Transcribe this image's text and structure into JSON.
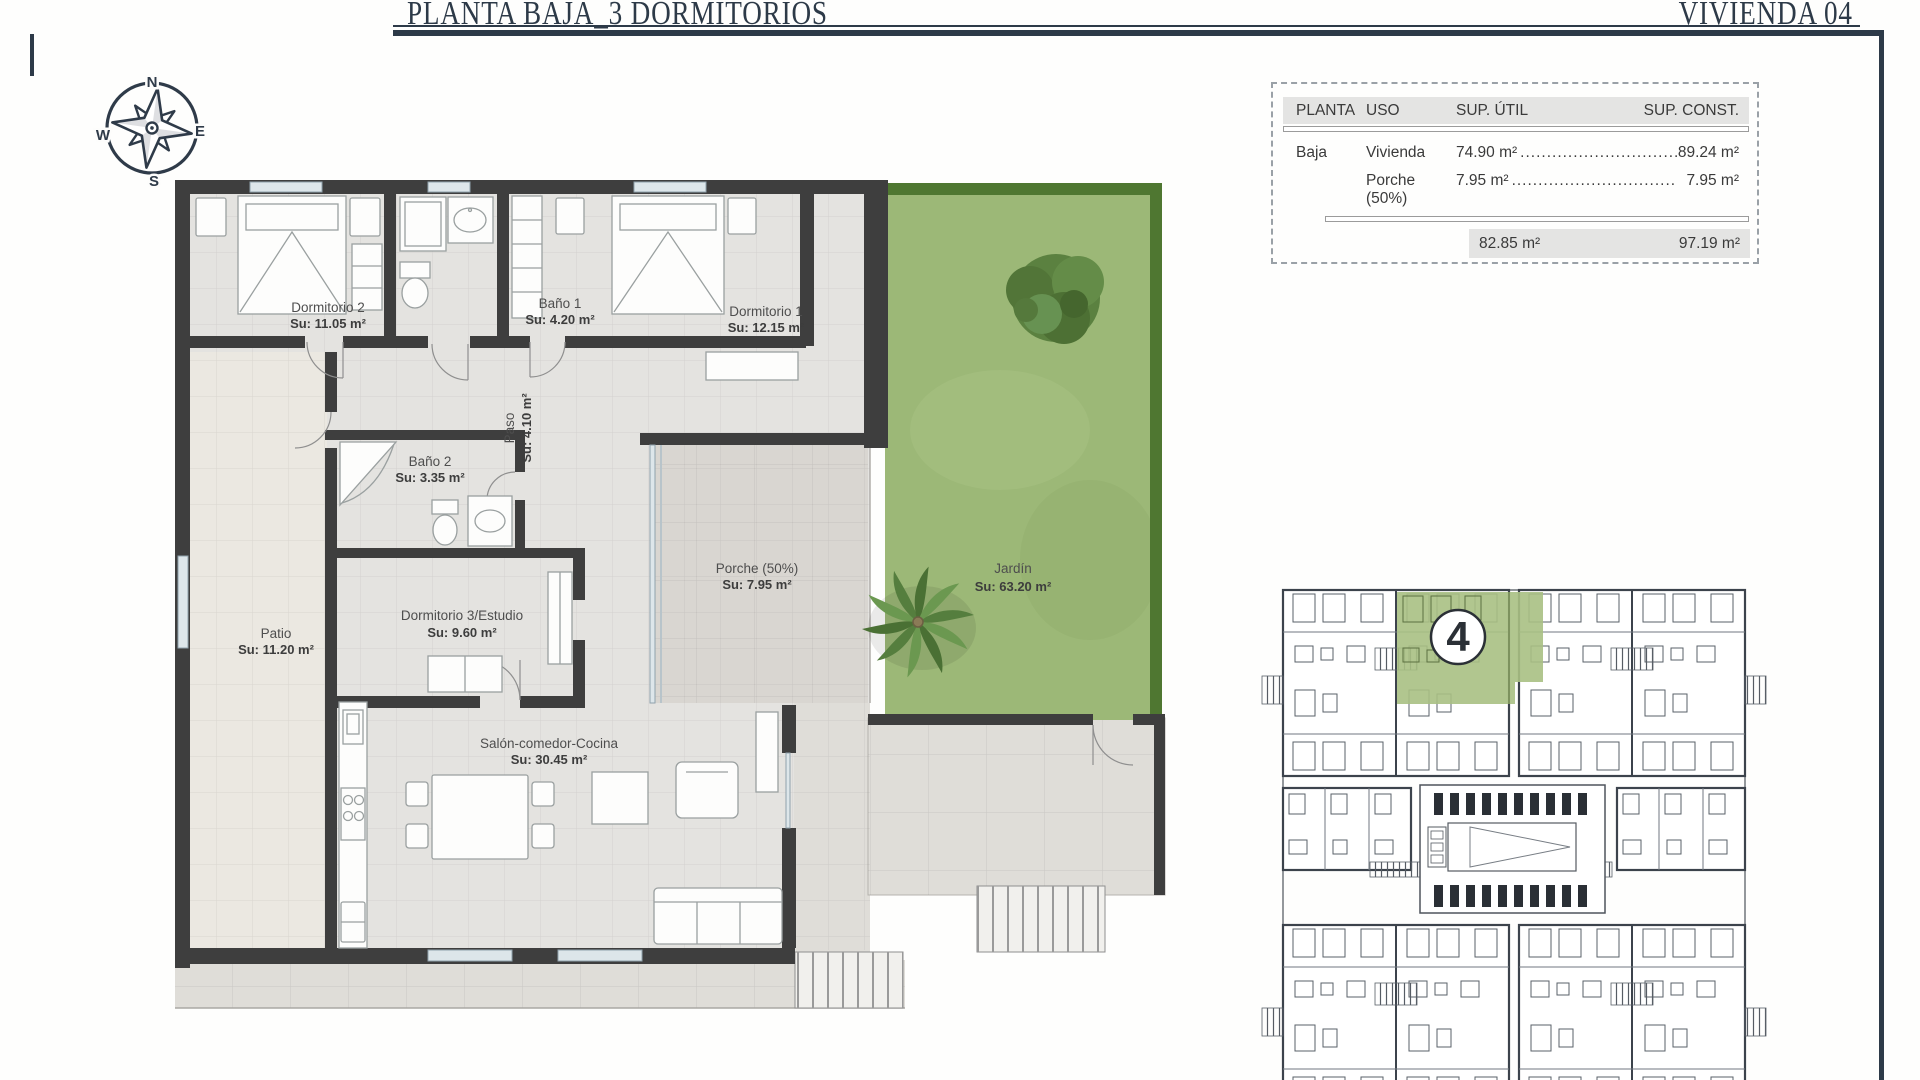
{
  "header": {
    "title": "PLANTA BAJA_3 DORMITORIOS",
    "unit": "VIVIENDA 04"
  },
  "compass": {
    "n": "N",
    "e": "E",
    "s": "S",
    "w": "W"
  },
  "summary_table": {
    "col_planta": "PLANTA",
    "col_uso": "USO",
    "col_sup_util": "SUP. ÚTIL",
    "col_sup_const": "SUP. CONST.",
    "rows": [
      {
        "planta": "Baja",
        "uso": "Vivienda",
        "sup_util": "74.90 m²",
        "leader": "........................................",
        "sup_const": "89.24 m²"
      },
      {
        "planta": "",
        "uso": "Porche (50%)",
        "sup_util": "7.95 m²",
        "leader": "........................................",
        "sup_const": "7.95 m²"
      }
    ],
    "total_sup_util": "82.85 m²",
    "total_sup_const": "97.19 m²"
  },
  "rooms": {
    "dormitorio2": {
      "name": "Dormitorio 2",
      "area": "Su: 11.05 m²"
    },
    "bano1": {
      "name": "Baño 1",
      "area": "Su: 4.20 m²"
    },
    "dormitorio1": {
      "name": "Dormitorio 1",
      "area": "Su: 12.15 m²"
    },
    "paso": {
      "name": "Paso",
      "area": "Su: 4.10 m²"
    },
    "bano2": {
      "name": "Baño 2",
      "area": "Su: 3.35 m²"
    },
    "dormitorio3": {
      "name": "Dormitorio 3/Estudio",
      "area": "Su: 9.60 m²"
    },
    "patio": {
      "name": "Patio",
      "area": "Su: 11.20 m²"
    },
    "porche": {
      "name": "Porche (50%)",
      "area": "Su: 7.95 m²"
    },
    "salon": {
      "name": "Salón-comedor-Cocina",
      "area": "Su: 30.45 m²"
    },
    "jardin": {
      "name": "Jardín",
      "area": "Su: 63.20 m²"
    }
  },
  "site_plan": {
    "badge": "4",
    "highlight_color": "#a9c083"
  }
}
